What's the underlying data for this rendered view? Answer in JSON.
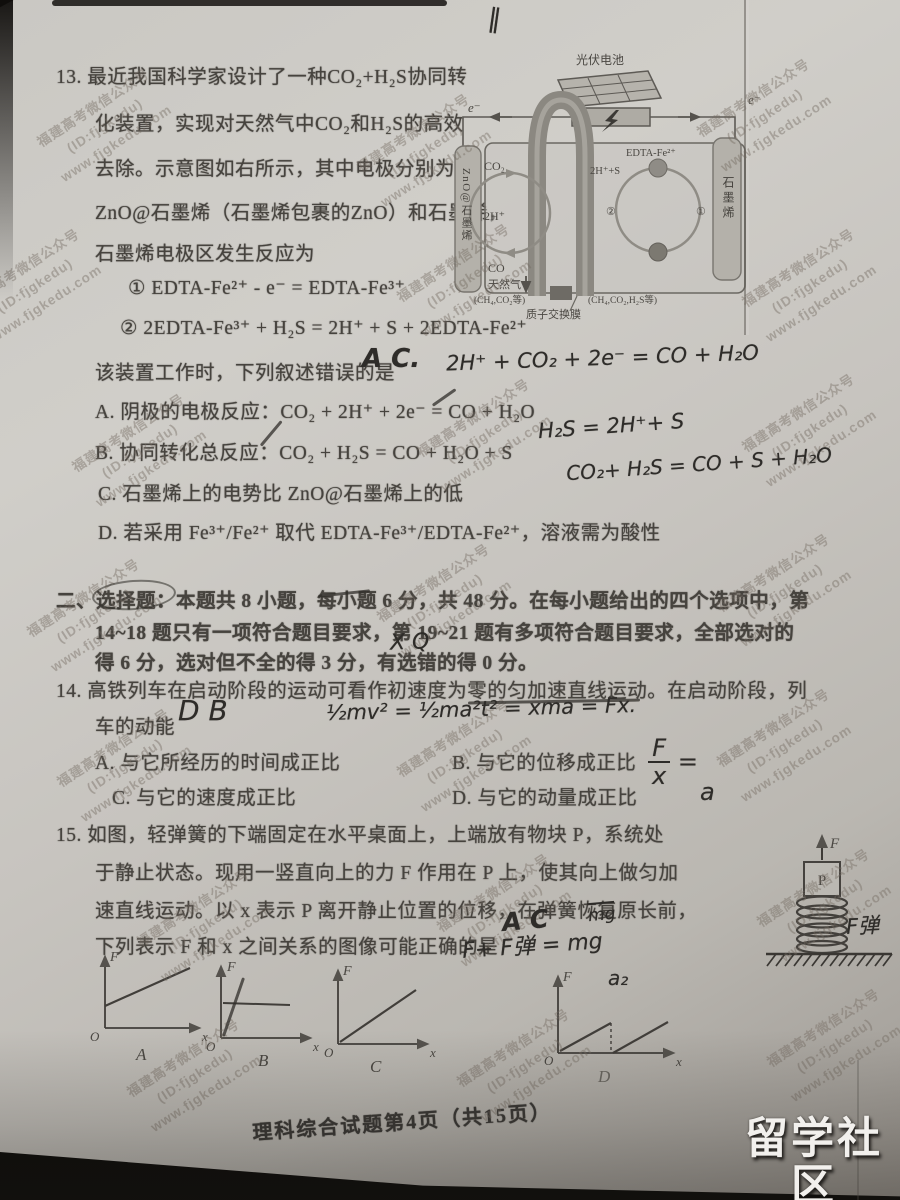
{
  "watermark": {
    "line1": "福建高考微信公众号",
    "line2": "(ID:fjgkedu)",
    "line3": "www.fjgkedu.com"
  },
  "top_mark": "‖",
  "q13": {
    "l1": "13. 最近我国科学家设计了一种CO₂+H₂S协同转",
    "l2": "化装置，实现对天然气中CO₂和H₂S的高效",
    "l3": "去除。示意图如右所示，其中电极分别为",
    "l4": "ZnO@石墨烯（石墨烯包裹的ZnO）和石墨烯，",
    "l5": "石墨烯电极区发生反应为",
    "eq1": "① EDTA-Fe²⁺ - e⁻ = EDTA-Fe³⁺",
    "eq2": "② 2EDTA-Fe³⁺ + H₂S = 2H⁺ + S + 2EDTA-Fe²⁺",
    "stem": "该装置工作时，下列叙述错误的是",
    "optA": "A. 阴极的电极反应：CO₂ + 2H⁺ + 2e⁻ = CO + H₂O",
    "optB": "B. 协同转化总反应：CO₂ + H₂S = CO + H₂O + S",
    "optC": "C. 石墨烯上的电势比 ZnO@石墨烯上的低",
    "optD": "D. 若采用 Fe³⁺/Fe²⁺ 取代 EDTA-Fe³⁺/EDTA-Fe²⁺，溶液需为酸性"
  },
  "diagram13": {
    "title": "光伏电池",
    "e_left": "e⁻",
    "e_right": "e⁻",
    "electrode_left": "ZnO@石墨烯",
    "electrode_right": "石墨烯",
    "co2": "CO₂",
    "h_left": "2H⁺",
    "co": "CO",
    "edta": "EDTA-Fe²⁺",
    "hs": "2H⁺+S",
    "num2": "②",
    "num1": "①",
    "gas_left": "天然气",
    "gas_left_sub": "(CH₄,CO₂等)",
    "gas_right": "(CH₄,CO₂,H₂S等)",
    "membrane": "质子交换膜"
  },
  "hw13": {
    "answer": "A C.",
    "eq_cathode": "2H⁺ + CO₂ + 2e⁻ =  CO   + H₂O",
    "eq_h2s": "H₂S = 2H⁺+ S",
    "eq_total": "CO₂+ H₂S = CO + S + H₂O"
  },
  "section2": {
    "l1": "二、选择题：本题共 8 小题，每小题 6 分，共 48 分。在每小题给出的四个选项中，第",
    "l2": "14~18 题只有一项符合题目要求，第 19~21 题有多项符合题目要求，全部选对的",
    "l3": "得 6 分，选对但不全的得 3 分，有选错的得 0 分。"
  },
  "hw_sec2": {
    "mark": "X Q"
  },
  "q14": {
    "l1": "14. 高铁列车在启动阶段的运动可看作初速度为零的匀加速直线运动。在启动阶段，列",
    "l2": "车的动能",
    "optA": "A. 与它所经历的时间成正比",
    "optB": "B. 与它的位移成正比",
    "optC": "C. 与它的速度成正比",
    "optD": "D. 与它的动量成正比"
  },
  "hw14": {
    "answer": "D B",
    "formula": "½mv² = ½ma²t² = xma = Fx.",
    "frac_num": "F",
    "frac_den": "x",
    "frac_eq": "=",
    "frac_res": "a"
  },
  "q15": {
    "l1": "15. 如图，轻弹簧的下端固定在水平桌面上，上端放有物块 P，系统处",
    "l2": "于静止状态。现用一竖直向上的力 F 作用在 P 上，使其向上做匀加",
    "l3": "速直线运动。以 x 表示 P 离开静止位置的位移，在弹簧恢复原长前，",
    "l4": "下列表示 F 和 x 之间关系的图像可能正确的是"
  },
  "hw15": {
    "answer": "A C",
    "eq": "F+ F弹 = mg",
    "mg": "mg",
    "spring_label": "F弹",
    "a2": "a₂"
  },
  "diagram15": {
    "force": "F",
    "block": "P"
  },
  "graphs": {
    "axis_y": "F",
    "axis_x": "x",
    "origin": "O",
    "a": "A",
    "b": "B",
    "c": "C",
    "d": "D"
  },
  "footer": "理科综合试题第4页（共15页）",
  "logo": {
    "title": "留学社区",
    "site": "bbs.liuxue86.com"
  },
  "colors": {
    "paper": "#c8c5c0",
    "ink": "#46433e",
    "handwriting": "#2e2c29",
    "watermark": "#736959",
    "photo_edge": "#0e0d0b"
  }
}
